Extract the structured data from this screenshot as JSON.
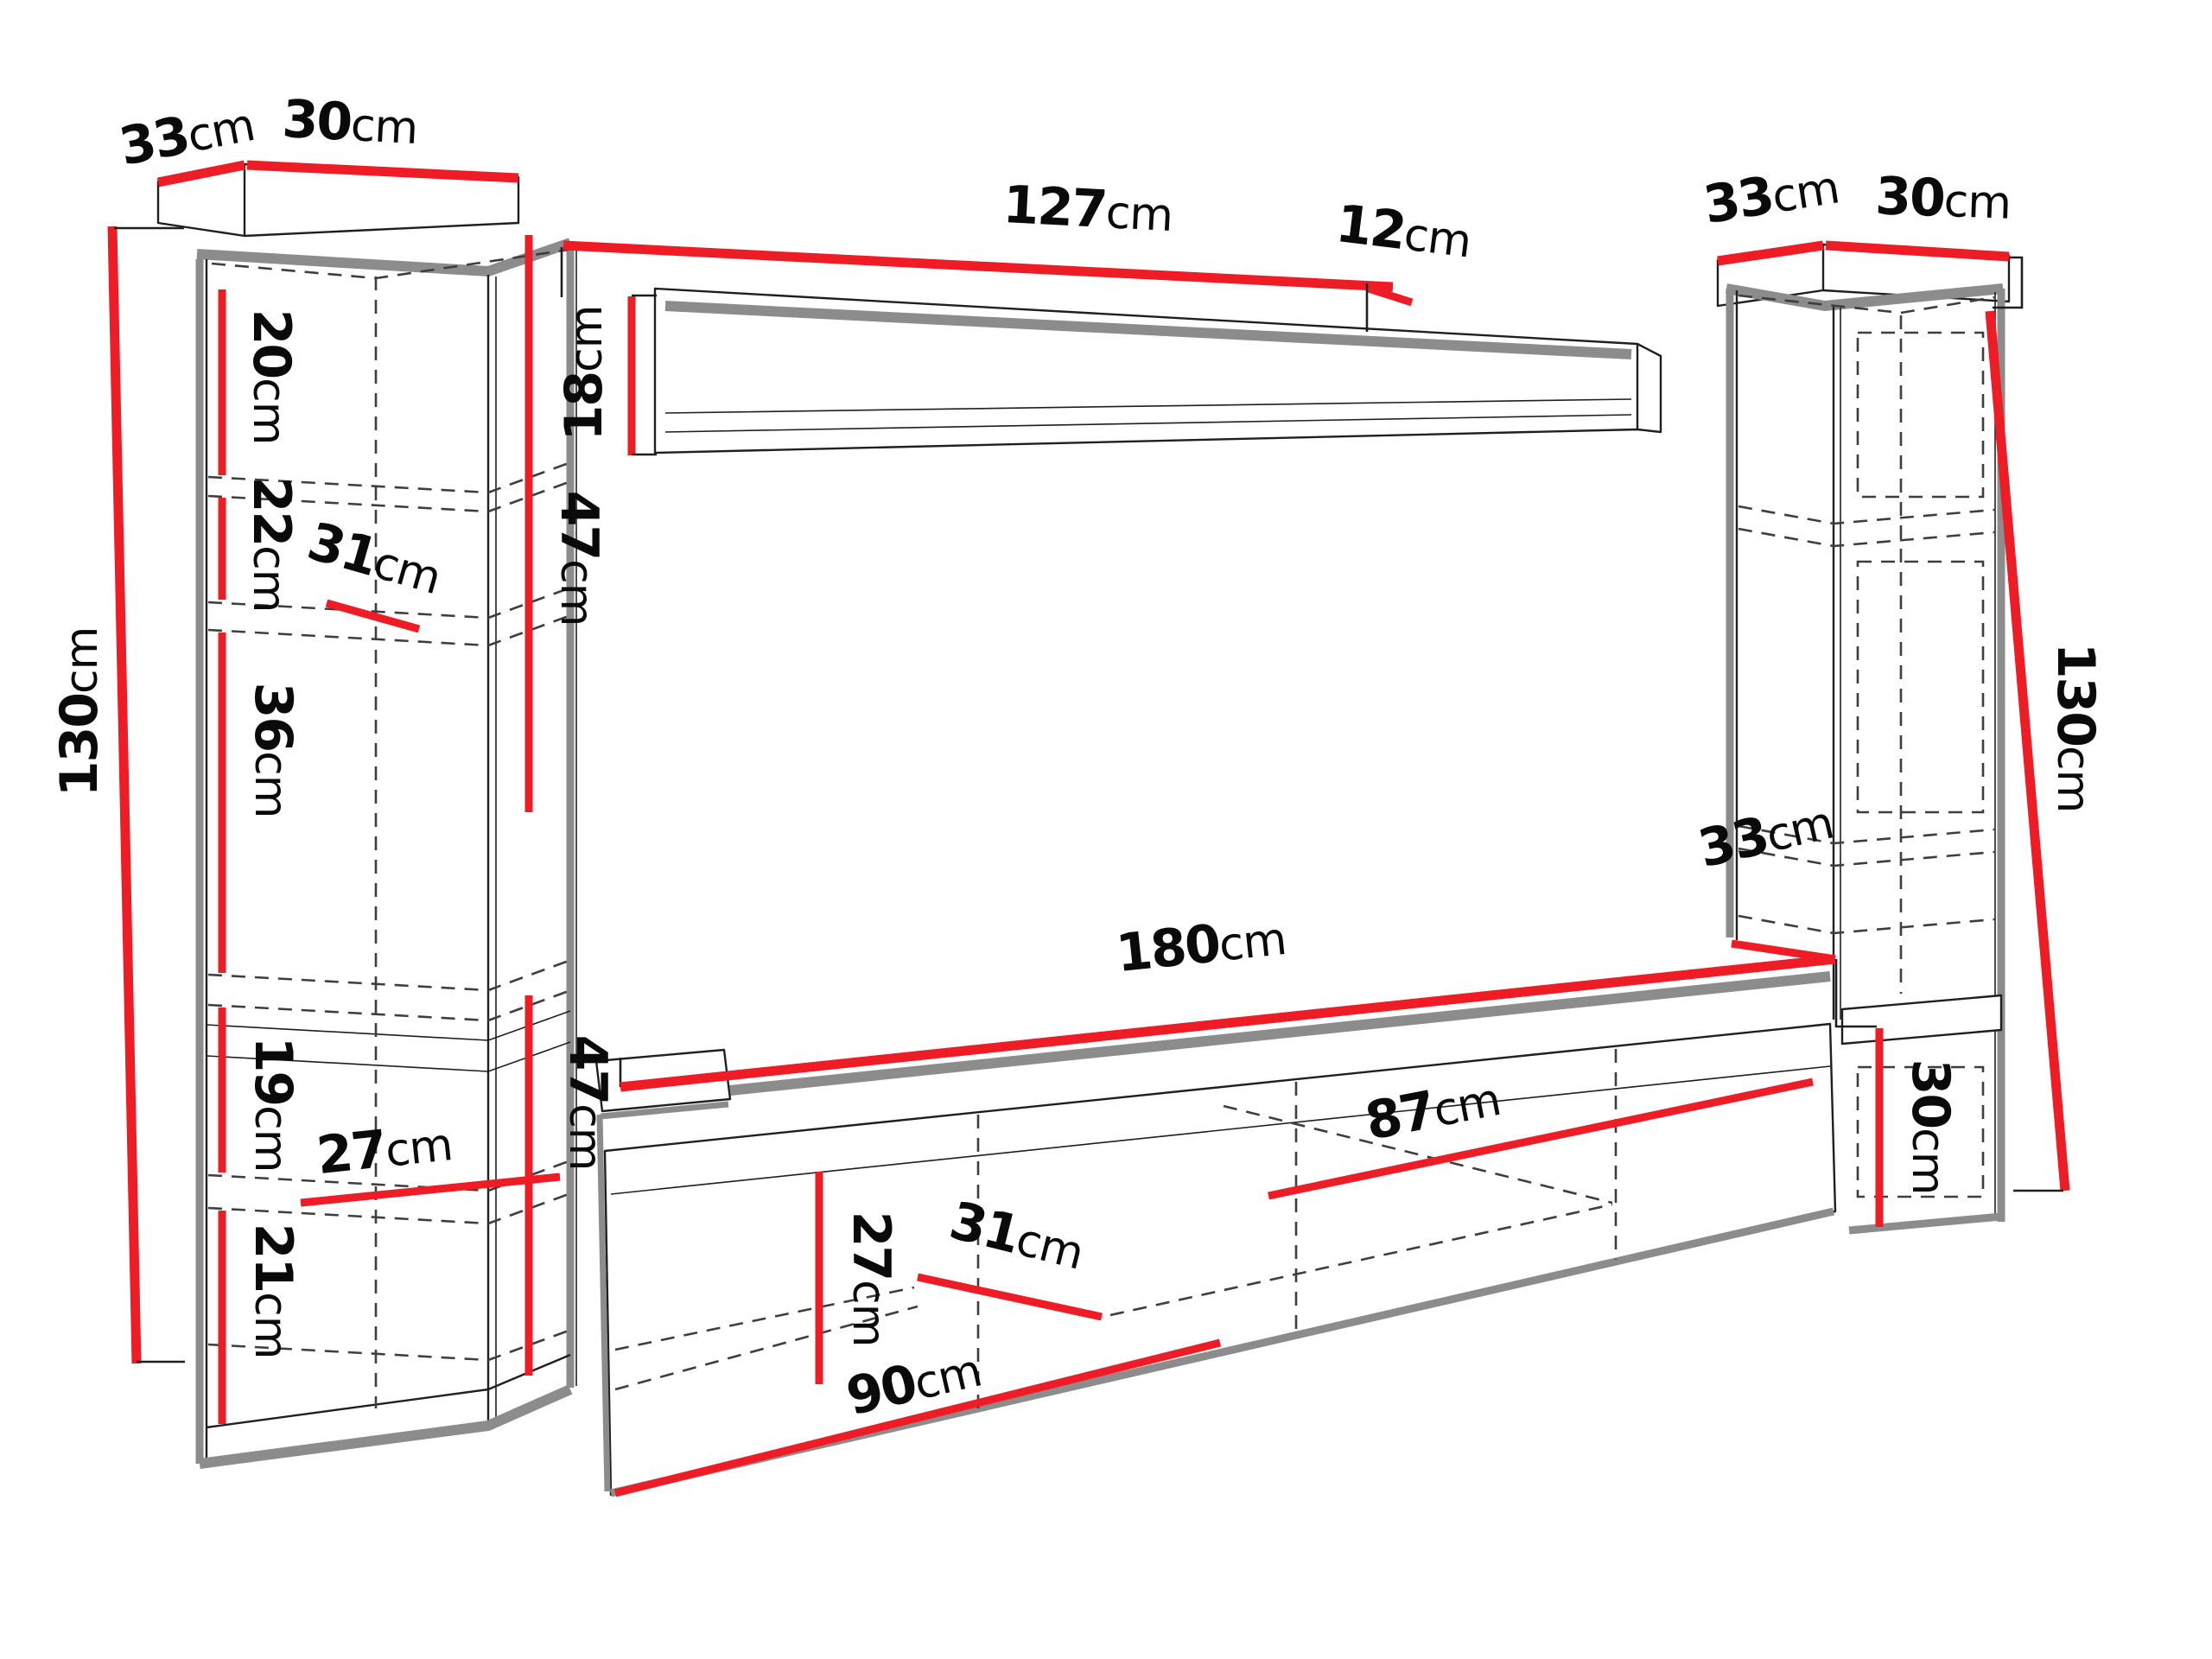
{
  "meta": {
    "kind": "furniture dimension diagram",
    "unit": "cm",
    "pieces": "wall unit: two tall side cabinets, wall shelf, TV stand"
  },
  "colors": {
    "red": "#ee1c24",
    "gray": "#8c8c8c",
    "ink": "#1f1f1f",
    "dash": "#3e3e3e",
    "bg": "#ffffff"
  },
  "components": {
    "left_column_cabinet": {
      "top_depth": "33cm",
      "top_width": "30cm",
      "height": "130cm",
      "sections_top_to_bottom": [
        "20cm",
        "22cm",
        "36cm",
        "19cm",
        "21cm"
      ],
      "shelf_depth": "31cm",
      "inner_width": "27cm",
      "side_span": "47cm"
    },
    "wall_shelf": {
      "width": "127cm",
      "end_depth": "12cm",
      "height": "18cm"
    },
    "right_column_cabinet": {
      "top_depth": "33cm",
      "top_width": "30cm",
      "height": "130cm",
      "lower_depth": "33cm",
      "lower_section_height": "30cm"
    },
    "tv_stand": {
      "width": "180cm",
      "height": "47cm",
      "left_section": "90cm",
      "right_section": "87cm",
      "inner_height": "27cm",
      "shelf_depth": "31cm"
    }
  },
  "labels": {
    "left_top_depth": {
      "value": "33",
      "unit": "cm"
    },
    "left_top_width": {
      "value": "30",
      "unit": "cm"
    },
    "left_height": {
      "value": "130",
      "unit": "cm"
    },
    "left_sec1": {
      "value": "20",
      "unit": "cm"
    },
    "left_sec2": {
      "value": "22",
      "unit": "cm"
    },
    "left_shelf_depth": {
      "value": "31",
      "unit": "cm"
    },
    "left_sec3": {
      "value": "36",
      "unit": "cm"
    },
    "left_sec4": {
      "value": "19",
      "unit": "cm"
    },
    "left_inner_width": {
      "value": "27",
      "unit": "cm"
    },
    "left_sec5": {
      "value": "21",
      "unit": "cm"
    },
    "left_side_upper": {
      "value": "47",
      "unit": "cm"
    },
    "shelf_height": {
      "value": "18",
      "unit": "cm"
    },
    "shelf_width": {
      "value": "127",
      "unit": "cm"
    },
    "shelf_end_depth": {
      "value": "12",
      "unit": "cm"
    },
    "right_top_depth": {
      "value": "33",
      "unit": "cm"
    },
    "right_top_width": {
      "value": "30",
      "unit": "cm"
    },
    "right_height": {
      "value": "130",
      "unit": "cm"
    },
    "stand_right_depth": {
      "value": "33",
      "unit": "cm"
    },
    "stand_width": {
      "value": "180",
      "unit": "cm"
    },
    "stand_height": {
      "value": "47",
      "unit": "cm"
    },
    "stand_right_section": {
      "value": "87",
      "unit": "cm"
    },
    "stand_inner_height": {
      "value": "27",
      "unit": "cm"
    },
    "stand_shelf_depth": {
      "value": "31",
      "unit": "cm"
    },
    "right_lower_height": {
      "value": "30",
      "unit": "cm"
    },
    "stand_left_section": {
      "value": "90",
      "unit": "cm"
    }
  }
}
